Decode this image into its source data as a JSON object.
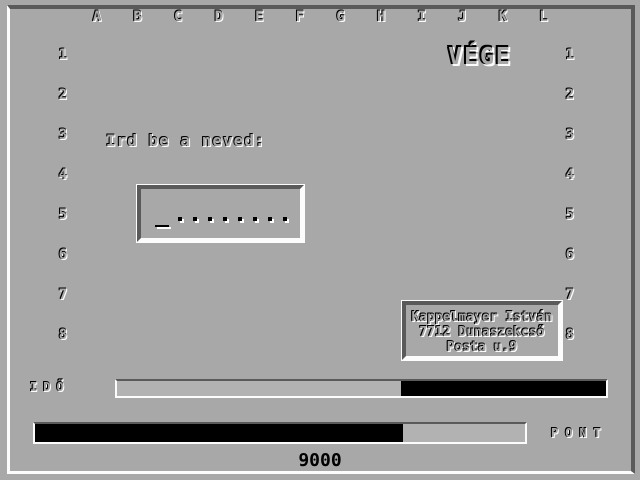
{
  "palette": {
    "background": "#a8a8a8",
    "shadow": "#5a5a5a",
    "highlight": "#fcfcfc",
    "bar_fill": "#000000",
    "bar_track": "#b2b2b2"
  },
  "grid": {
    "column_labels": [
      "A",
      "B",
      "C",
      "D",
      "E",
      "F",
      "G",
      "H",
      "I",
      "J",
      "K",
      "L"
    ],
    "row_labels": [
      "1",
      "2",
      "3",
      "4",
      "5",
      "6",
      "7",
      "8"
    ]
  },
  "status": {
    "title": "VÉGE"
  },
  "name_entry": {
    "prompt": "Ird be a neved:",
    "cursor": "_",
    "char_slots": 8
  },
  "credit_box": {
    "line1": "Kappelmayer István",
    "line2": "7712 Dunaszekcső",
    "line3": "Posta u.9"
  },
  "time_bar": {
    "label": "IDŐ",
    "elapsed_pct": 42,
    "remaining_pct": 58
  },
  "score_bar": {
    "label": "PONT",
    "fill_pct": 75
  },
  "score": {
    "value": "9000"
  }
}
